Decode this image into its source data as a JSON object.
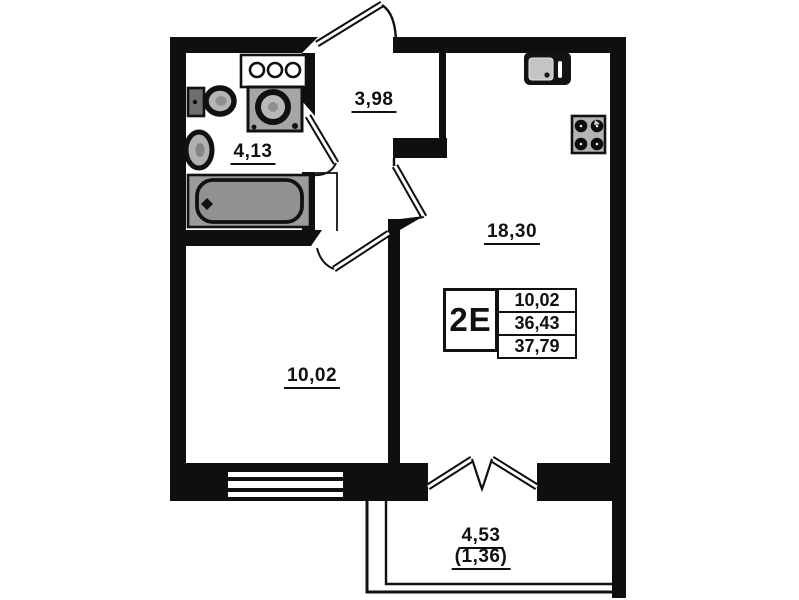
{
  "plan": {
    "unit_type": "2Е",
    "info_table": {
      "rows": [
        "10,02",
        "36,43",
        "37,79"
      ]
    },
    "rooms": {
      "bathroom": {
        "area": "4,13"
      },
      "hallway": {
        "area": "3,98"
      },
      "kitchen_living": {
        "area": "18,30"
      },
      "room": {
        "area": "10,02"
      },
      "balcony": {
        "area": "4,53",
        "area_reduced": "(1,36)"
      }
    },
    "fixtures": [
      "bathtub",
      "toilet",
      "wash-basin",
      "washing-machine",
      "washer-control-panel",
      "kitchen-sink",
      "stove"
    ],
    "colors": {
      "walls": "#0f0f0f",
      "fixture_gray": "#a6a6a6",
      "background": "#ffffff"
    }
  }
}
